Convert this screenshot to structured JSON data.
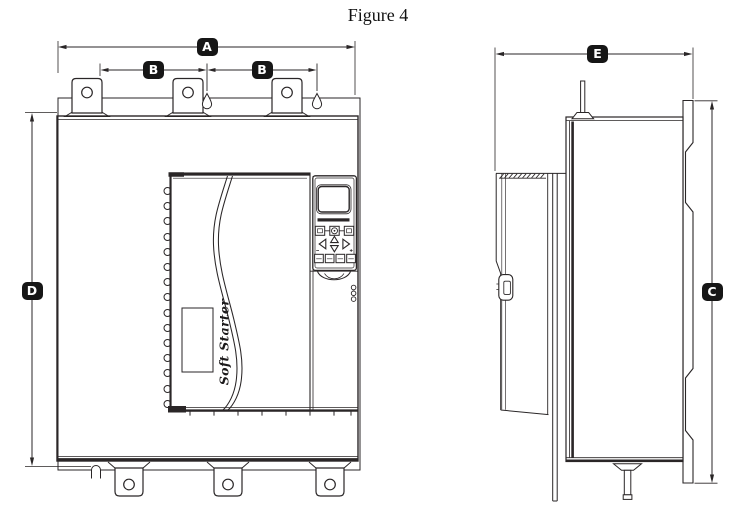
{
  "figure": {
    "title": "Figure 4"
  },
  "device": {
    "panel_text": "Soft Starter"
  },
  "dims": {
    "A": "A",
    "B": "B",
    "C": "C",
    "D": "D",
    "E": "E"
  },
  "colors": {
    "line": "#2a2627",
    "label_bg": "#161616",
    "label_fg": "#ffffff",
    "background": "#ffffff"
  }
}
